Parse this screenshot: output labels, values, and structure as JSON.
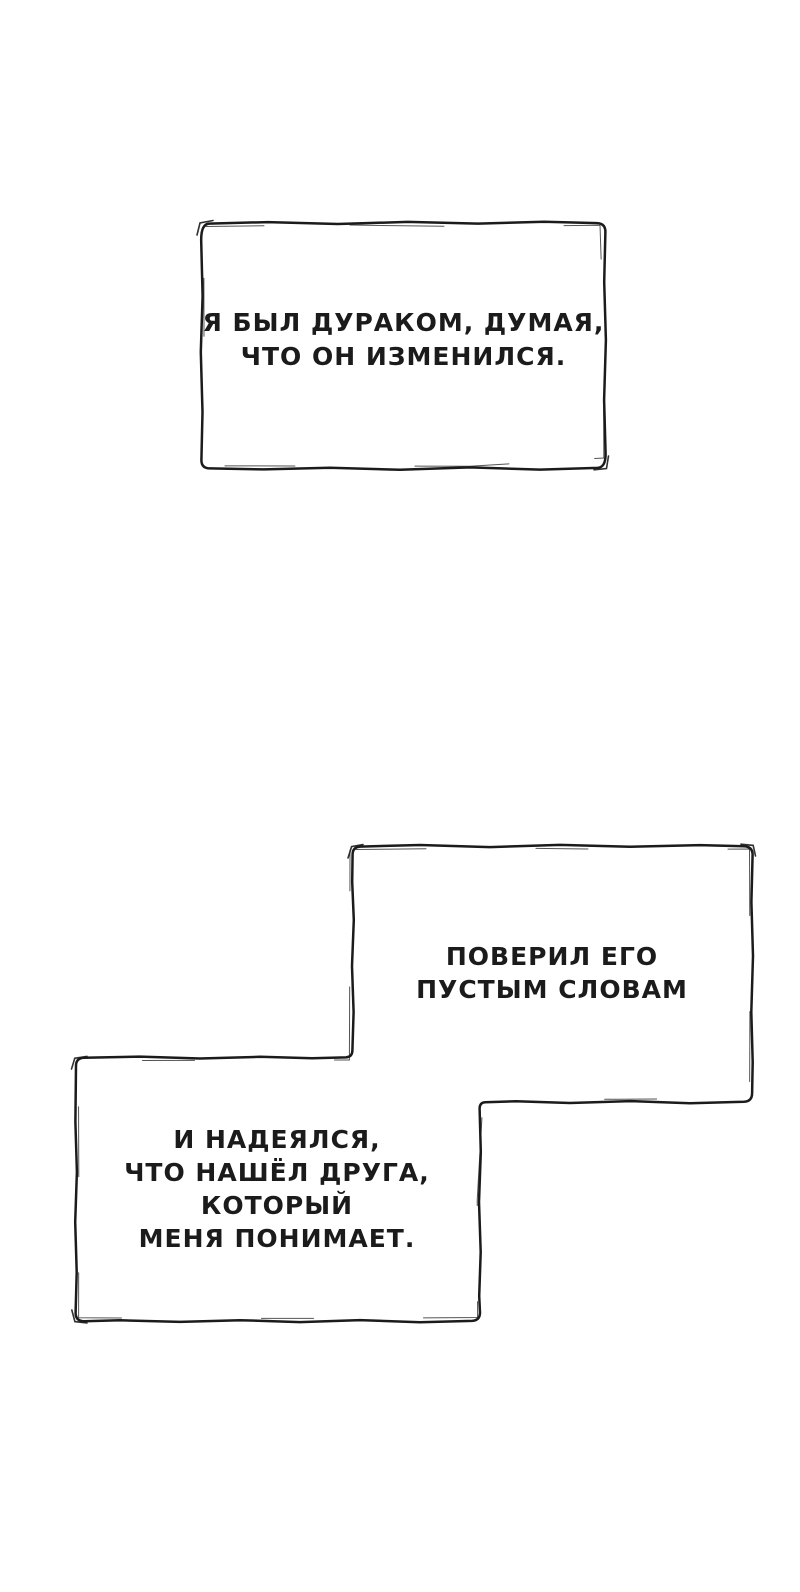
{
  "theme": {
    "ink": "#1b1b1b",
    "paper": "#ffffff"
  },
  "panels": [
    {
      "id": "caption-top",
      "lines": [
        "Я БЫЛ ДУРАКОМ, ДУМАЯ,",
        "ЧТО ОН ИЗМЕНИЛСЯ."
      ]
    },
    {
      "id": "caption-middle",
      "lines": [
        "ПОВЕРИЛ ЕГО",
        "ПУСТЫМ СЛОВАМ"
      ]
    },
    {
      "id": "caption-bottom",
      "lines": [
        "И НАДЕЯЛСЯ,",
        "ЧТО НАШЁЛ ДРУГА,",
        "КОТОРЫЙ",
        "МЕНЯ ПОНИМАЕТ."
      ]
    }
  ]
}
